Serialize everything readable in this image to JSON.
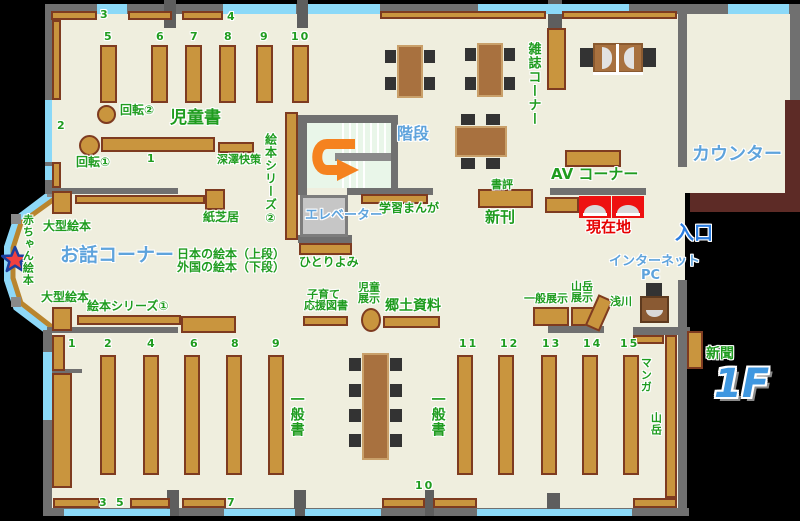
{
  "t": {
    "floor": "1F",
    "jidosho": "児童書",
    "ohanashi_corner": "お話コーナー",
    "kaidan": "階段",
    "elevator": "エレベーター",
    "zasshi_corner": "雑誌コーナー",
    "counter": "カウンター",
    "av_corner": "AV コーナー",
    "shohyo": "書評",
    "shinkan": "新刊",
    "genzaichi": "現在地",
    "iriguchi": "入口",
    "internet": "インターネット",
    "pc": "PC",
    "shinbun": "新聞",
    "ippansho": "一般書",
    "kyodo_shiryo": "郷土資料",
    "jido": "児童",
    "tenji": "展示",
    "kosodate": "子育て",
    "ouen_tosho": "応援図書",
    "ippan_tenji": "一般展示",
    "sangaku": "山岳",
    "asakawa": "浅川",
    "manga": "マンガ",
    "gakushu_manga": "学習まんが",
    "hitoriyomi": "ひとりよみ",
    "kamishibai": "紙芝居",
    "ogata_ehon": "大型絵本",
    "ehon_series1": "絵本シリーズ①",
    "ehon_series2": "絵本シリーズ②",
    "nihon_ehon": "日本の絵本（上段）",
    "gaikoku_ehon": "外国の絵本（下段）",
    "akachan_ehon": "赤ちゃん絵本",
    "kaiten1": "回転①",
    "kaiten2": "回転②",
    "fukazawa": "深澤快策"
  },
  "numbers": {
    "n1": "1",
    "n2": "2",
    "n3": "3",
    "n4": "4",
    "n5": "5",
    "n6": "6",
    "n7": "7",
    "n8": "8",
    "n9": "9",
    "n10": "10",
    "n11": "11",
    "n12": "12",
    "n13": "13",
    "n14": "14",
    "n15": "15"
  },
  "colors": {
    "floor": "#efeede",
    "wall": "#707070",
    "window": "#8bd9f8",
    "shelf": "#c9953e",
    "shelf_border": "#7e3b20",
    "counter": "#5d2b26",
    "green_label": "#1f9c1f",
    "blue_label": "#5ea3dc",
    "red_label": "#e60000",
    "arrow": "#f5821f",
    "star": "#f04040"
  }
}
